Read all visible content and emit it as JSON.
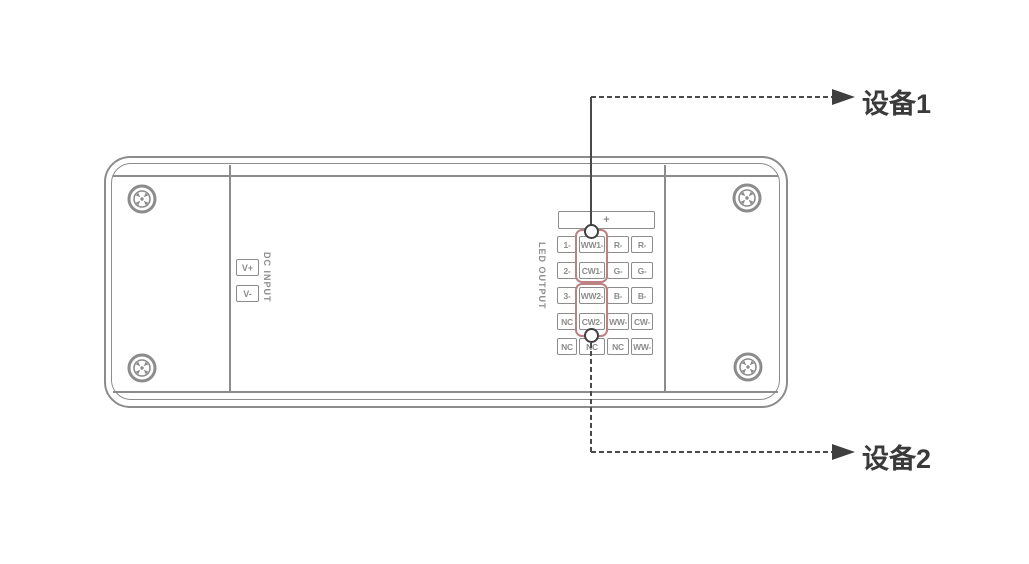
{
  "canvas": {
    "width": 1029,
    "height": 564
  },
  "colors": {
    "background": "#ffffff",
    "device_outline": "#8c8c8c",
    "terminal_text": "#8c8c8c",
    "highlight_box": "#bc8181",
    "callout_line": "#4a4a4a",
    "callout_text": "#3a3a3a"
  },
  "device": {
    "dc_input": {
      "label": "DC INPUT",
      "terminals": [
        "V+",
        "V-"
      ]
    },
    "led_output": {
      "label": "LED OUTPUT",
      "common_terminal": "+",
      "rows": [
        [
          "1-",
          "WW1-",
          "R-",
          "R-"
        ],
        [
          "2-",
          "CW1-",
          "G-",
          "G-"
        ],
        [
          "3-",
          "WW2-",
          "B-",
          "B-"
        ],
        [
          "NC",
          "CW2-",
          "WW-",
          "CW-"
        ],
        [
          "NC",
          "NC",
          "NC",
          "WW-"
        ]
      ]
    }
  },
  "callouts": {
    "device1": {
      "label": "设备1"
    },
    "device2": {
      "label": "设备2"
    }
  }
}
